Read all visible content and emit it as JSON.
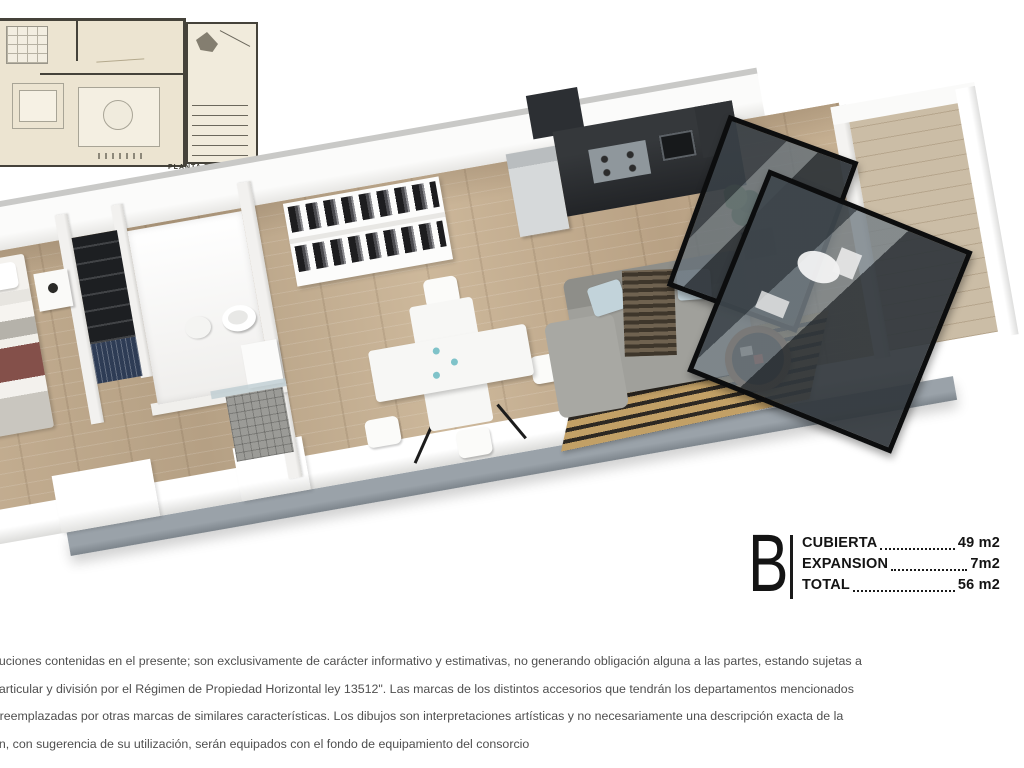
{
  "mini_plan": {
    "caption": "PLANTA TIPO"
  },
  "unit_info": {
    "unit_label": "B",
    "rows": [
      {
        "label": "CUBIERTA",
        "value": "49 m2"
      },
      {
        "label": "EXPANSION",
        "value": "7m2"
      },
      {
        "label": "TOTAL",
        "value": "56 m2"
      }
    ]
  },
  "disclaimer": {
    "lines": [
      "buciones contenidas en el presente; son exclusivamente de carácter informativo y estimativas, no generando obligación alguna a las partes, estando sujetas a",
      "particular y división por el Régimen de Propiedad Horizontal ley 13512\". Las marcas de los distintos accesorios que tendrán los departamentos mencionados",
      "r reemplazadas por otras marcas de similares características. Los dibujos son interpretaciones artísticas y no necesariamente una descripción exacta de la",
      "ón, con sugerencia de su utilización, serán equipados con el fondo de equipamiento del consorcio"
    ]
  },
  "colors": {
    "floor_wood": "#c1aa8b",
    "wall_white": "#f7f7f5",
    "dark_furniture": "#26282a",
    "sofa_gray": "#9f9f9a",
    "rug_tan": "#c2a066",
    "accent_maroon": "#84504a",
    "glass_dark": "#363d42",
    "plan_cream": "#ece4d1",
    "fascia_gray": "#8b939a",
    "text_black": "#141414",
    "text_gray": "#4f4f4f"
  }
}
